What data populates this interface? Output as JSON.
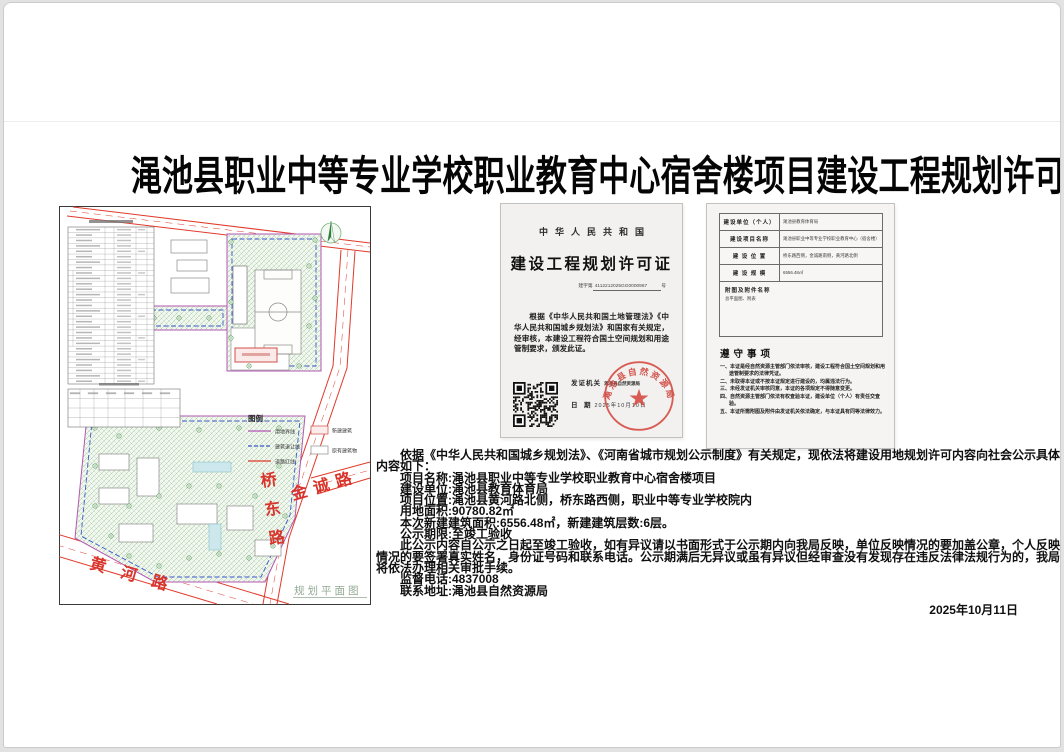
{
  "page": {
    "title": "渑池县职业中等专业学校职业教育中心宿舍楼项目建设工程规划许可批后公示"
  },
  "site_plan": {
    "caption": "规划平面图",
    "roads": {
      "right": "桥东路",
      "upper_right": "金诚路",
      "bottom": "黄河路"
    },
    "legend": {
      "title": "图例",
      "line_items": [
        {
          "label": "用地界线",
          "color": "#b257b2",
          "style": "solid"
        },
        {
          "label": "建筑退让线",
          "color": "#3a57c8",
          "style": "dashed"
        },
        {
          "label": "道路红线",
          "color": "#e03a2a",
          "style": "solid"
        }
      ],
      "box_items": [
        {
          "label": "新建建筑",
          "color": "#d05048"
        },
        {
          "label": "原有建筑物",
          "color": "#999999"
        }
      ]
    },
    "colors": {
      "road_red_line": "#e03a2a",
      "site_boundary": "#b257b2",
      "setback_line": "#3a57c8",
      "green_area": "#9cc49c",
      "new_building": "#d05048"
    }
  },
  "permit": {
    "country": "中华人民共和国",
    "title": "建设工程规划许可证",
    "number_prefix": "建字第",
    "number": "4112212025GG0000967",
    "number_suffix": "号",
    "body": "根据《中华人民共和国土地管理法》《中华人民共和国城乡规划法》和国家有关规定，经审核，本建设工程符合国土空间规划和用途管制要求，颁发此证。",
    "issuer_label": "发证机关",
    "issuer": "渑池县自然资源局",
    "date_label": "日　期",
    "date": "2025年10月10日",
    "seal_text": "渑池县自然资源局"
  },
  "permit_back": {
    "rows": [
      {
        "label": "建设单位（个人）",
        "value": "渑池县教育体育局"
      },
      {
        "label": "建设项目名称",
        "value": "渑池县职业中等专业学校职业教育中心（宿舍楼）"
      },
      {
        "label": "建 设 位 置",
        "value": "桥东路西侧，金诚路南侧，黄河路北侧"
      },
      {
        "label": "建 设 规 模",
        "value": "6556.48㎡"
      }
    ],
    "attachment_label": "附图及附件名称",
    "attachment_value": "总平面图、附表",
    "notes_title": "遵守事项",
    "notes": [
      "一、本证是经自然资源主管部门依法审核，建设工程符合国土空间规划和用途管制要求的法律凭证。",
      "二、未取得本证或不按本证规定进行建设的，均属违法行为。",
      "三、未经发证机关审核同意，本证的各项规定不得随意变更。",
      "四、自然资源主管部门依法有权查验本证，建设单位（个人）有责任交查验。",
      "五、本证所需附图及附件由发证机关依法确定，与本证具有同等法律效力。"
    ]
  },
  "notice": {
    "paragraphs": [
      "依据《中华人民共和国城乡规划法》、《河南省城市规划公示制度》有关规定，现依法将建设用地规划许可内容向社会公示具体内容如下：",
      "项目名称:渑池县职业中等专业学校职业教育中心宿舍楼项目",
      "建设单位:渑池县教育体育局",
      "项目位置:渑池县黄河路北侧，桥东路西侧，职业中等专业学校院内",
      "用地面积:90780.82㎡",
      "本次新建建筑面积:6556.48㎡，新建建筑层数:6层。",
      "公示期限:至竣工验收",
      "此公示内容自公示之日起至竣工验收，如有异议请以书面形式于公示期内向我局反映，单位反映情况的要加盖公章，个人反映情况的要签署真实姓名，身份证号码和联系电话。公示期满后无异议或虽有异议但经审查没有发现存在违反法律法规行为的，我局将依法办理相关审批手续。",
      "监督电话:4837008",
      "联系地址:渑池县自然资源局"
    ],
    "date": "2025年10月11日"
  }
}
